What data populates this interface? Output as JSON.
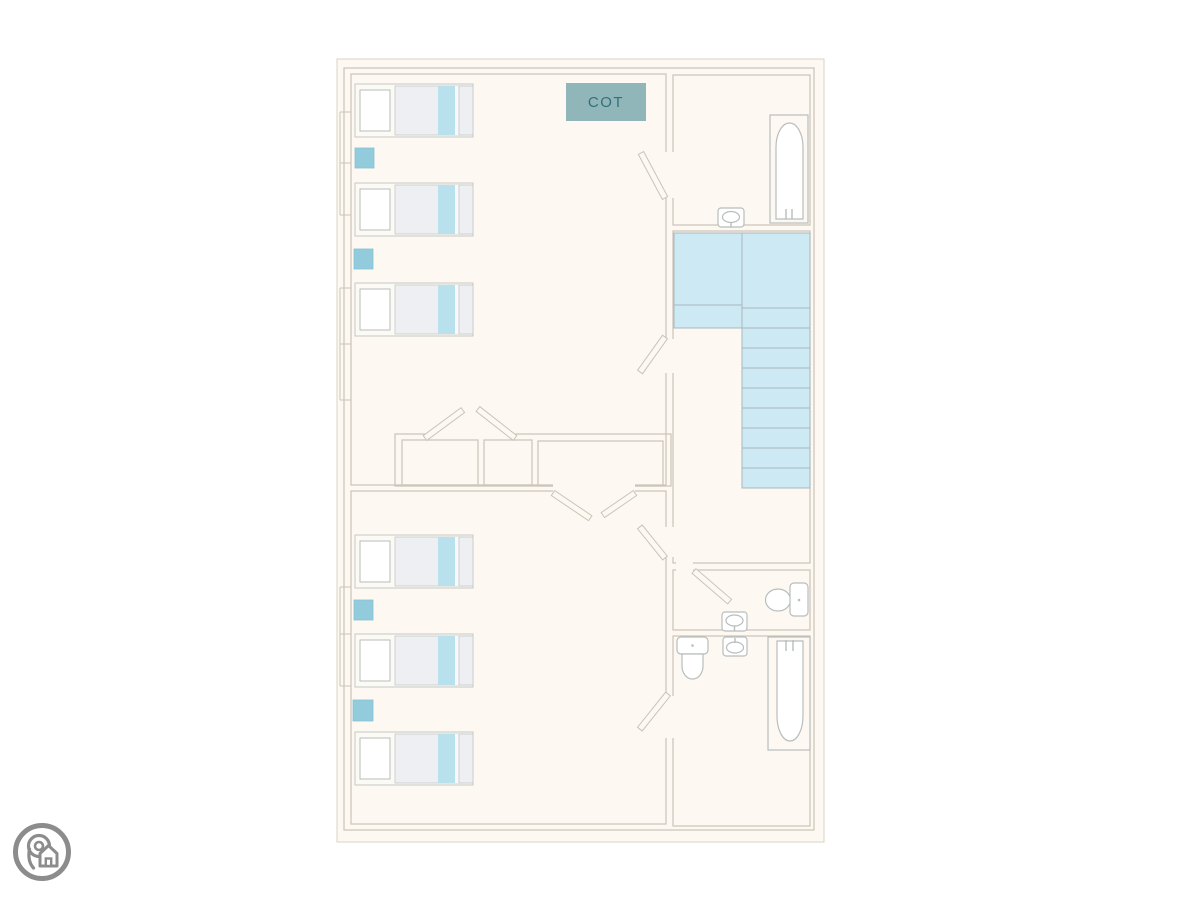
{
  "palette": {
    "page_bg": "#ffffff",
    "floor": "#fdf8f1",
    "card_border": "#d9d2c6",
    "wall": "#cbc4b8",
    "bed_border": "#c5c7c5",
    "bed_bg": "#fcfaf5",
    "pillow_border": "#babdbd",
    "duvet": "#edeff2",
    "bed_stripe": "#b9e1ed",
    "bed_gap": "#f7f9fa",
    "side_table": "#92cbdb",
    "side_table_border": "#86c1d3",
    "stairs_fill": "#cde9f4",
    "stairs_line": "#a9b7bd",
    "fixture_fill": "#ffffff",
    "fixture_line": "#b9bdbd",
    "cot_fill": "#90b6b9",
    "cot_text": "#33707c",
    "logo": "#8c8c8c"
  },
  "plan": {
    "cot_label": "COT",
    "rooms": [
      {
        "id": "bedroom-top",
        "beds": 3,
        "side_tables": 2,
        "has_cot": true
      },
      {
        "id": "bedroom-bottom",
        "beds": 3,
        "side_tables": 2
      },
      {
        "id": "bathroom-top",
        "fixtures": [
          "bath",
          "sink"
        ]
      },
      {
        "id": "stair-hall",
        "fixtures": [
          "staircase"
        ]
      },
      {
        "id": "wc",
        "fixtures": [
          "toilet",
          "sink"
        ]
      },
      {
        "id": "bathroom-bottom",
        "fixtures": [
          "toilet",
          "sink",
          "bath"
        ]
      },
      {
        "id": "wardrobe-block",
        "compartments": 3
      }
    ],
    "stairs": {
      "landing_cells": 2,
      "left_steps": 1,
      "right_steps": 9
    }
  },
  "branding": {
    "logo_icon": "location-pin-house-icon"
  }
}
